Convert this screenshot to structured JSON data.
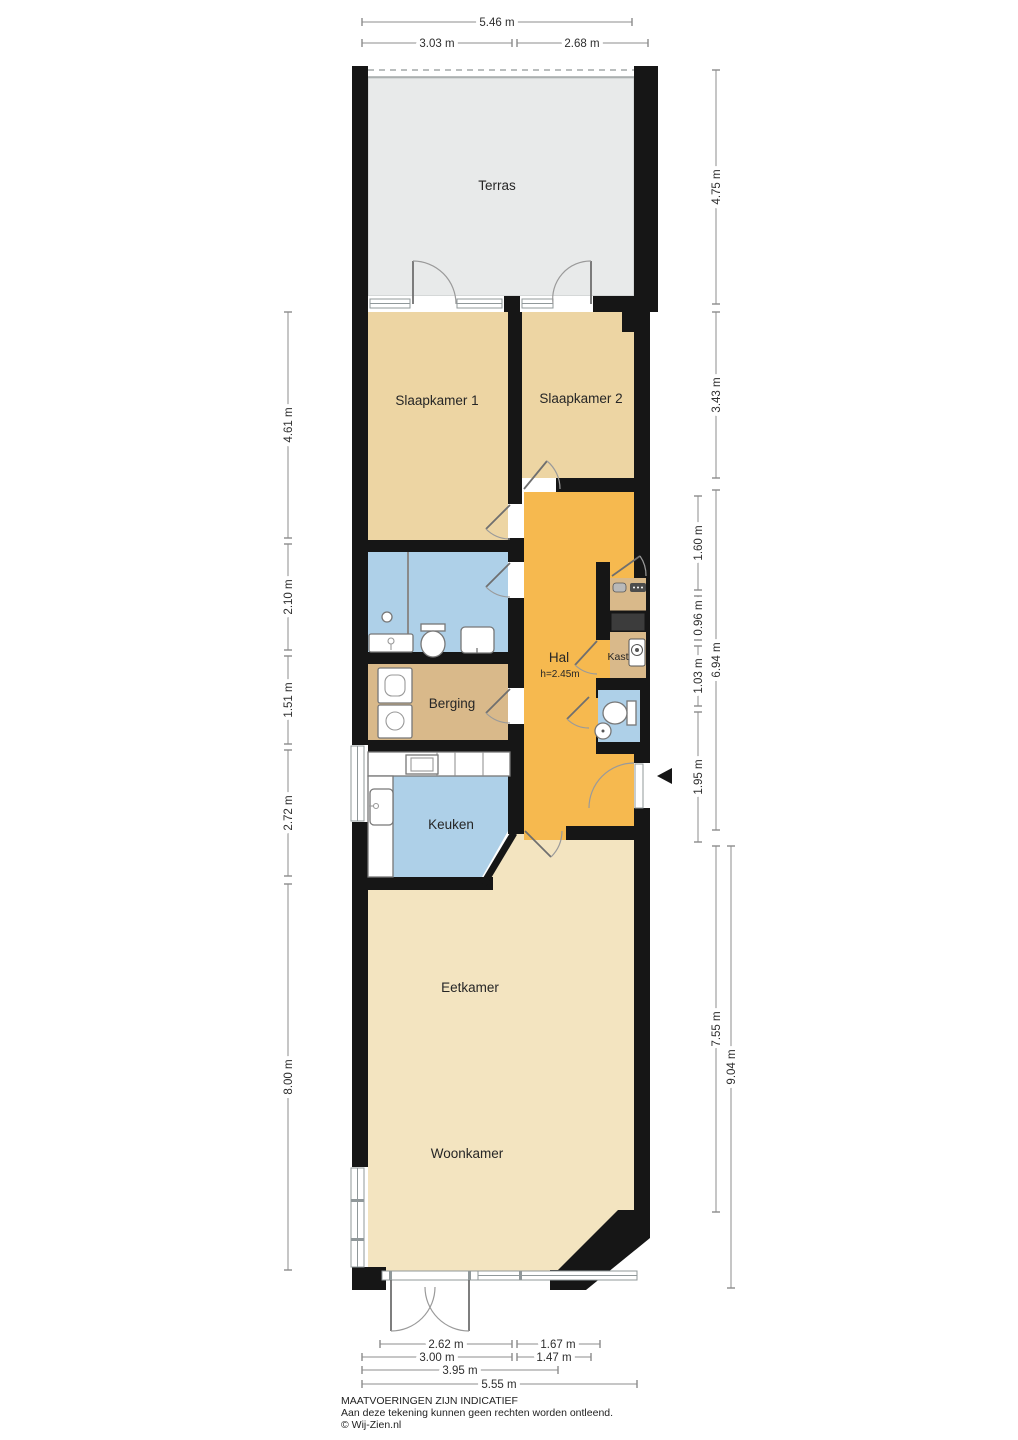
{
  "plan_title": "Apartment floor plan",
  "rooms": {
    "terras": "Terras",
    "slaapkamer1": "Slaapkamer 1",
    "slaapkamer2": "Slaapkamer 2",
    "hal": "Hal",
    "hal_ceiling": "h=2.45m",
    "kast": "Kast",
    "berging": "Berging",
    "keuken": "Keuken",
    "eetkamer": "Eetkamer",
    "woonkamer": "Woonkamer"
  },
  "dims": {
    "top": {
      "total": "5.46 m",
      "left_section": "3.03 m",
      "right_section": "2.68 m"
    },
    "left": {
      "bedrooms": "4.61 m",
      "bathroom": "2.10 m",
      "storage": "1.51 m",
      "kitchen": "2.72 m",
      "living": "8.00 m"
    },
    "right": {
      "terrace": "4.75 m",
      "bedrooms": "3.43 m",
      "hall_upper": "1.60 m",
      "meter_shaft": "0.96 m",
      "hall_total": "6.94 m",
      "closet": "1.03 m",
      "entry": "1.95 m",
      "living": "7.55 m",
      "living_total": "9.04 m"
    },
    "bottom": {
      "doors": "2.62 m",
      "window": "1.67 m",
      "doors_outer": "3.00 m",
      "window_outer": "1.47 m",
      "bay": "3.95 m",
      "total": "5.55 m"
    }
  },
  "footer": {
    "line1": "MAATVOERINGEN ZIJN INDICATIEF",
    "line2": "Aan deze tekening kunnen geen rechten worden ontleend.",
    "line3": "© Wij-Zien.nl"
  },
  "icons": {
    "entrance_arrow": "left-pointing-triangle"
  },
  "colors": {
    "wall": "#161616",
    "terrace": "#e8eaea",
    "bedroom": "#edd5a3",
    "hall": "#f6b94f",
    "living": "#f3e4c0",
    "wet": "#aed0e8",
    "storage": "#d9b98a",
    "shaft": "#3c3c3c"
  }
}
